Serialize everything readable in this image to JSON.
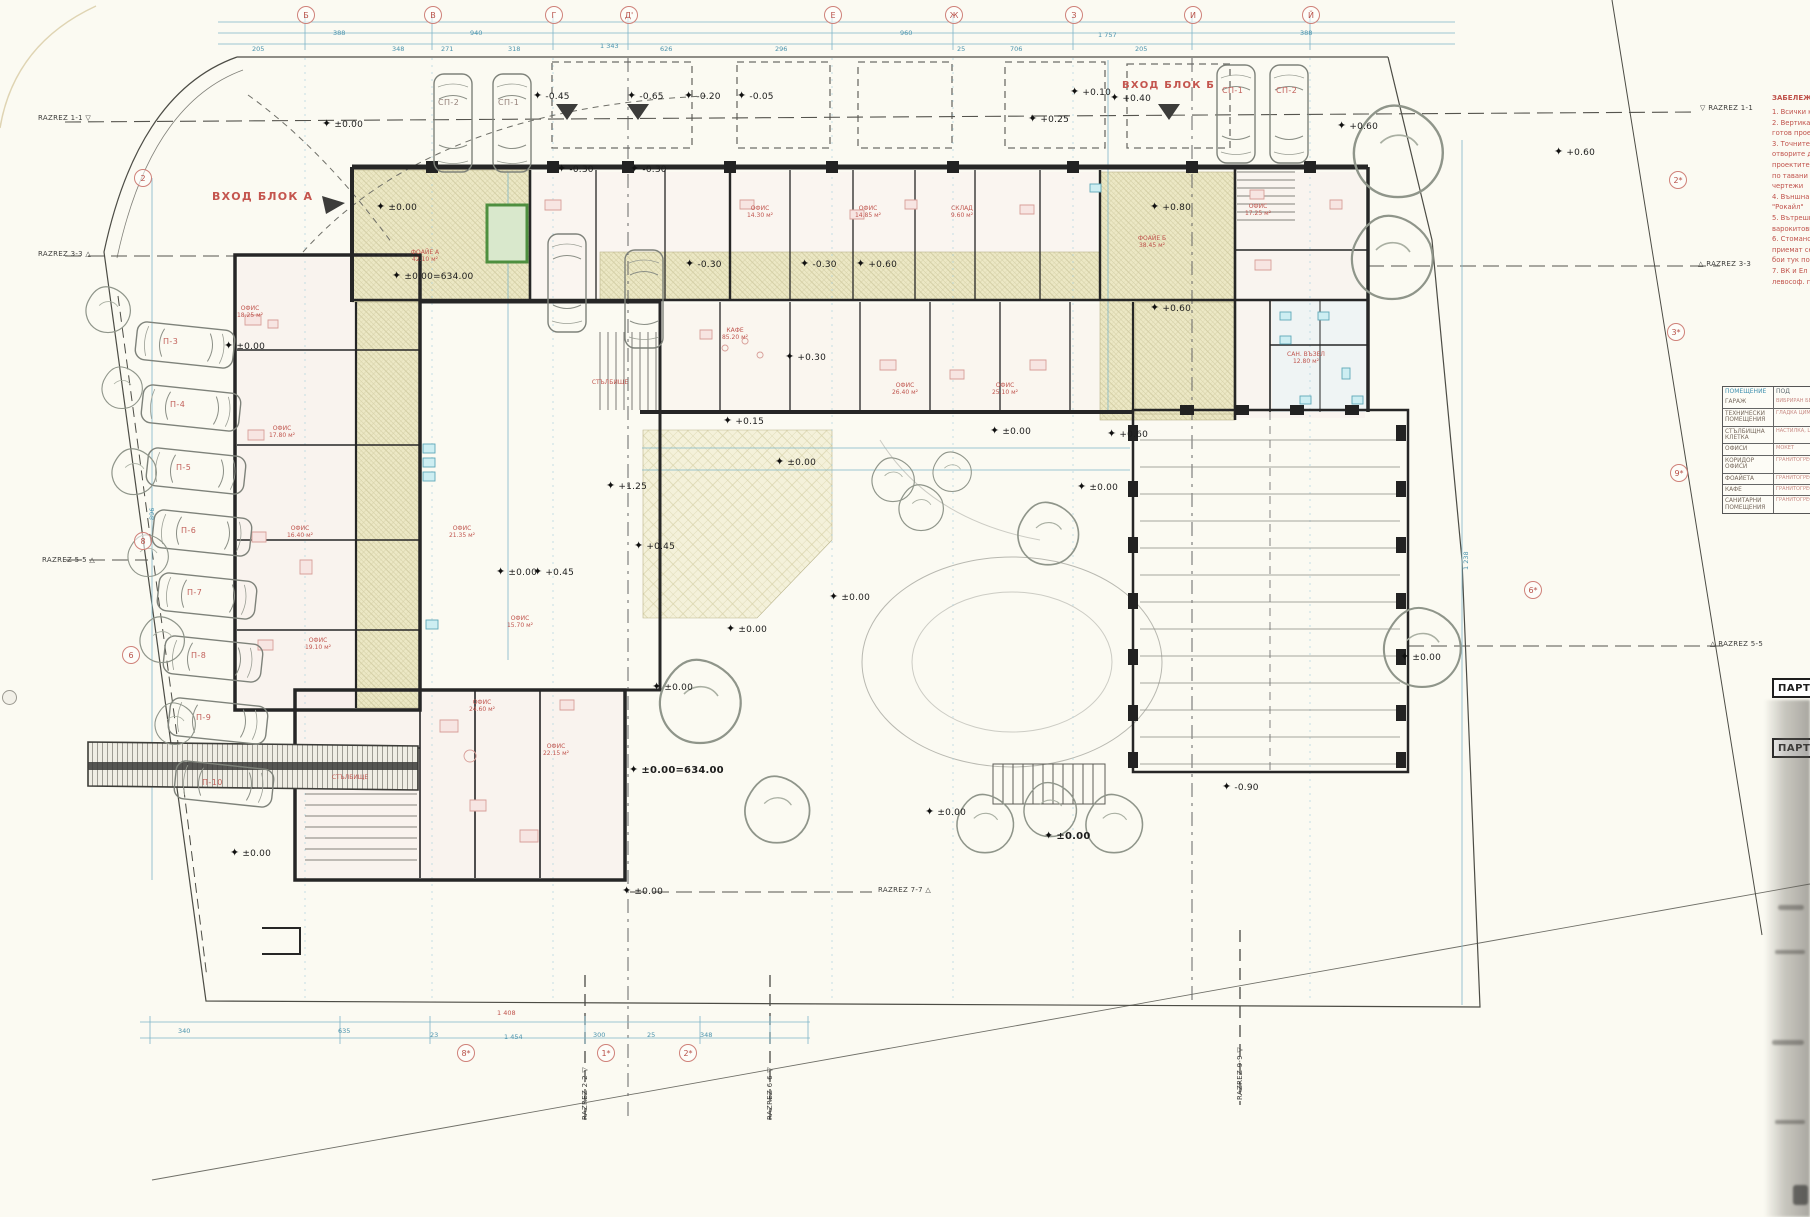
{
  "marker_glyph": "✦",
  "title_labels": {
    "entrance_a": "ВХОД БЛОК А",
    "entrance_b": "ВХОД БЛОК Б"
  },
  "grid": {
    "top": [
      {
        "t": "Б",
        "x": 305
      },
      {
        "t": "В",
        "x": 432
      },
      {
        "t": "Г",
        "x": 553
      },
      {
        "t": "Д'",
        "x": 628
      },
      {
        "t": "Е",
        "x": 832
      },
      {
        "t": "Ж",
        "x": 953
      },
      {
        "t": "З",
        "x": 1073
      },
      {
        "t": "И",
        "x": 1192
      },
      {
        "t": "Й",
        "x": 1310
      }
    ],
    "left": [
      {
        "t": "2",
        "x": 142,
        "y": 177
      },
      {
        "t": "8",
        "x": 142,
        "y": 540
      },
      {
        "t": "6",
        "x": 130,
        "y": 654
      }
    ],
    "bottom": [
      {
        "t": "8*",
        "x": 465,
        "y": 1052
      },
      {
        "t": "1*",
        "x": 605,
        "y": 1052
      },
      {
        "t": "2*",
        "x": 687,
        "y": 1052
      }
    ],
    "mid": [
      {
        "t": "2*",
        "x": 1677,
        "y": 179
      },
      {
        "t": "3*",
        "x": 1675,
        "y": 331
      },
      {
        "t": "9*",
        "x": 1678,
        "y": 472
      },
      {
        "t": "6*",
        "x": 1532,
        "y": 589
      }
    ]
  },
  "elevations": [
    {
      "t": "±0.00",
      "x": 338,
      "y": 124
    },
    {
      "t": "-0.45",
      "x": 549,
      "y": 96
    },
    {
      "t": "-0.65",
      "x": 643,
      "y": 96
    },
    {
      "t": "-0.20",
      "x": 700,
      "y": 96
    },
    {
      "t": "-0.05",
      "x": 753,
      "y": 96
    },
    {
      "t": "+0.10",
      "x": 1086,
      "y": 92
    },
    {
      "t": "+0.40",
      "x": 1126,
      "y": 98
    },
    {
      "t": "+0.25",
      "x": 1044,
      "y": 119
    },
    {
      "t": "+0.60",
      "x": 1353,
      "y": 126
    },
    {
      "t": "+0.60",
      "x": 1570,
      "y": 152
    },
    {
      "t": "±0.00",
      "x": 392,
      "y": 207
    },
    {
      "t": "±0.00=634.00",
      "x": 408,
      "y": 276
    },
    {
      "t": "-0.30",
      "x": 573,
      "y": 169
    },
    {
      "t": "-0.30",
      "x": 646,
      "y": 169
    },
    {
      "t": "-0.30",
      "x": 701,
      "y": 264
    },
    {
      "t": "-0.30",
      "x": 816,
      "y": 264
    },
    {
      "t": "+0.60",
      "x": 872,
      "y": 264
    },
    {
      "t": "+0.80",
      "x": 1166,
      "y": 207
    },
    {
      "t": "+0.60",
      "x": 1166,
      "y": 308
    },
    {
      "t": "+0.30",
      "x": 801,
      "y": 357
    },
    {
      "t": "+0.60",
      "x": 1123,
      "y": 434
    },
    {
      "t": "±0.00",
      "x": 1006,
      "y": 431
    },
    {
      "t": "+0.15",
      "x": 739,
      "y": 421
    },
    {
      "t": "±0.00",
      "x": 791,
      "y": 462
    },
    {
      "t": "+1.25",
      "x": 622,
      "y": 486
    },
    {
      "t": "+0.45",
      "x": 650,
      "y": 546
    },
    {
      "t": "+0.45",
      "x": 549,
      "y": 572
    },
    {
      "t": "±0.00",
      "x": 512,
      "y": 572
    },
    {
      "t": "±0.00",
      "x": 845,
      "y": 597
    },
    {
      "t": "±0.00",
      "x": 1093,
      "y": 487
    },
    {
      "t": "±0.00",
      "x": 742,
      "y": 629
    },
    {
      "t": "±0.00",
      "x": 668,
      "y": 687
    },
    {
      "t": "±0.00",
      "x": 240,
      "y": 346
    },
    {
      "t": "±0.00",
      "x": 246,
      "y": 853
    },
    {
      "t": "±0.00",
      "x": 1416,
      "y": 657
    },
    {
      "t": "±0.00=634.00",
      "x": 645,
      "y": 770,
      "b": 1
    },
    {
      "t": "-0.90",
      "x": 1238,
      "y": 787
    },
    {
      "t": "±0.00",
      "x": 941,
      "y": 812
    },
    {
      "t": "±0.00",
      "x": 1060,
      "y": 836,
      "b": 1
    },
    {
      "t": "±0.00",
      "x": 638,
      "y": 891
    }
  ],
  "razrez": [
    {
      "t": "RAZREZ 1-1",
      "g": "▽",
      "x": 38,
      "y": 114,
      "order": "post",
      "rot": 0
    },
    {
      "t": "RAZREZ 3-3",
      "g": "△",
      "x": 38,
      "y": 250,
      "order": "post",
      "rot": 0
    },
    {
      "t": "RAZREZ 5-5",
      "g": "△",
      "x": 42,
      "y": 556,
      "order": "post",
      "rot": 0
    },
    {
      "t": "RAZREZ 1-1",
      "g": "▽",
      "x": 1700,
      "y": 104,
      "order": "pre",
      "rot": 0
    },
    {
      "t": "RAZREZ 3-3",
      "g": "△",
      "x": 1698,
      "y": 260,
      "order": "pre",
      "rot": 0
    },
    {
      "t": "RAZREZ 5-5",
      "g": "△",
      "x": 1710,
      "y": 640,
      "order": "pre",
      "rot": 0
    },
    {
      "t": "RAZREZ 7-7",
      "g": "△",
      "x": 878,
      "y": 886,
      "order": "post",
      "rot": 0
    },
    {
      "t": "RAZREZ 2-2",
      "g": "▽",
      "x": 581,
      "y": 1120,
      "order": "post",
      "rot": -90
    },
    {
      "t": "RAZREZ 6-6",
      "g": "▽",
      "x": 766,
      "y": 1120,
      "order": "post",
      "rot": -90
    },
    {
      "t": "RAZREZ 9-9",
      "g": "▽",
      "x": 1236,
      "y": 1100,
      "order": "post",
      "rot": -90
    }
  ],
  "parking": {
    "left": [
      {
        "t": "П-3",
        "x": 163,
        "y": 337
      },
      {
        "t": "П-4",
        "x": 170,
        "y": 400
      },
      {
        "t": "П-5",
        "x": 176,
        "y": 463
      },
      {
        "t": "П-6",
        "x": 181,
        "y": 526
      },
      {
        "t": "П-7",
        "x": 187,
        "y": 588
      },
      {
        "t": "П-8",
        "x": 191,
        "y": 651
      },
      {
        "t": "П-9",
        "x": 196,
        "y": 713
      },
      {
        "t": "П-10",
        "x": 202,
        "y": 778
      }
    ],
    "top": [
      {
        "t": "СП-2",
        "x": 438,
        "y": 98,
        "red": 0
      },
      {
        "t": "СП-1",
        "x": 498,
        "y": 98,
        "red": 0
      },
      {
        "t": "СП-1",
        "x": 1222,
        "y": 86,
        "red": 1
      },
      {
        "t": "СП-2",
        "x": 1276,
        "y": 86,
        "red": 1
      }
    ]
  },
  "notes": {
    "header": "ЗАБЕЛЕЖКИ:",
    "lines": [
      "1. Всички коти са в метри",
      "2. Вертикалната планировка",
      "готов проект",
      "3. Точните размери на",
      "отворите да се вземат",
      "проектите на доставчика",
      "по тавани виж отделни",
      "чертежи",
      "4. Външна мазилка тип",
      "\"Рокайл\"",
      "5. Вътрешни мазилки -",
      "варокитови",
      "6. Стоманобетонови елем.",
      "приемат се с латексови",
      "бои тук посочени",
      "7. ВК и Ел инсталации виж",
      "левософ. проекти"
    ]
  },
  "legend": {
    "headers": [
      "ПОМЕЩЕНИЕ",
      "ПОД"
    ],
    "rows": [
      {
        "name": "ГАРАЖ",
        "floor": "ВИБРИРАН БЕТОН"
      },
      {
        "name": "ТЕХНИЧЕСКИ ПОМЕЩЕНИЯ",
        "floor": "ГЛАДКА ЦИМ. ЗАМАЗКА"
      },
      {
        "name": "СТЪЛБИЩНА КЛЕТКА",
        "floor": "НАСТИЛКА, ЦОКЪЛ"
      },
      {
        "name": "ОФИСИ",
        "floor": "МОКЕТ"
      },
      {
        "name": "КОРИДОР ОФИСИ",
        "floor": "ГРАНИТОГРЕС"
      },
      {
        "name": "ФОАЙЕТА",
        "floor": "ГРАНИТОГРЕС"
      },
      {
        "name": "КАФЕ",
        "floor": "ГРАНИТОГРЕС"
      },
      {
        "name": "САНИТАРНИ ПОМЕЩЕНИЯ",
        "floor": "ГРАНИТОГРЕС"
      }
    ]
  },
  "parter": {
    "labels": [
      "ПАРТЕР",
      "ПАРТЕР"
    ]
  },
  "rooms": [
    {
      "n": "ФОАЙЕ А",
      "a": "42.10 м²",
      "x": 425,
      "y": 250
    },
    {
      "n": "КАФЕ",
      "a": "85.20 м²",
      "x": 735,
      "y": 328
    },
    {
      "n": "ОФИС",
      "a": "18.25 м²",
      "x": 250,
      "y": 306
    },
    {
      "n": "ОФИС",
      "a": "17.80 м²",
      "x": 282,
      "y": 426
    },
    {
      "n": "ОФИС",
      "a": "16.40 м²",
      "x": 300,
      "y": 526
    },
    {
      "n": "ОФИС",
      "a": "19.10 м²",
      "x": 318,
      "y": 638
    },
    {
      "n": "ОФИС",
      "a": "21.35 м²",
      "x": 462,
      "y": 526
    },
    {
      "n": "ОФИС",
      "a": "15.70 м²",
      "x": 520,
      "y": 616
    },
    {
      "n": "ОФИС",
      "a": "24.60 м²",
      "x": 482,
      "y": 700
    },
    {
      "n": "ОФИС",
      "a": "22.15 м²",
      "x": 556,
      "y": 744
    },
    {
      "n": "ОФИС",
      "a": "14.30 м²",
      "x": 760,
      "y": 206
    },
    {
      "n": "ОФИС",
      "a": "14.85 м²",
      "x": 868,
      "y": 206
    },
    {
      "n": "СКЛАД",
      "a": "9.60 м²",
      "x": 962,
      "y": 206
    },
    {
      "n": "ОФИС",
      "a": "26.40 м²",
      "x": 905,
      "y": 383
    },
    {
      "n": "ОФИС",
      "a": "25.10 м²",
      "x": 1005,
      "y": 383
    },
    {
      "n": "ФОАЙЕ Б",
      "a": "38.45 м²",
      "x": 1152,
      "y": 236
    },
    {
      "n": "ОФИС",
      "a": "17.25 м²",
      "x": 1258,
      "y": 204
    },
    {
      "n": "САН. ВЪЗЕЛ",
      "a": "12.80 м²",
      "x": 1306,
      "y": 352
    },
    {
      "n": "СТЪЛБИЩЕ",
      "a": "",
      "x": 610,
      "y": 380
    },
    {
      "n": "СТЪЛБИЩЕ",
      "a": "",
      "x": 350,
      "y": 775
    }
  ],
  "dims": {
    "top": [
      {
        "t": "205",
        "x": 252,
        "y": 45
      },
      {
        "t": "388",
        "x": 333,
        "y": 29
      },
      {
        "t": "348",
        "x": 392,
        "y": 45
      },
      {
        "t": "271",
        "x": 441,
        "y": 45
      },
      {
        "t": "318",
        "x": 508,
        "y": 45
      },
      {
        "t": "1 343",
        "x": 600,
        "y": 42
      },
      {
        "t": "940",
        "x": 470,
        "y": 29
      },
      {
        "t": "626",
        "x": 660,
        "y": 45
      },
      {
        "t": "296",
        "x": 775,
        "y": 45
      },
      {
        "t": "960",
        "x": 900,
        "y": 29
      },
      {
        "t": "25",
        "x": 957,
        "y": 45
      },
      {
        "t": "706",
        "x": 1010,
        "y": 45
      },
      {
        "t": "1 757",
        "x": 1098,
        "y": 31
      },
      {
        "t": "205",
        "x": 1135,
        "y": 45
      },
      {
        "t": "388",
        "x": 1300,
        "y": 29
      }
    ],
    "bottom": [
      {
        "t": "1 408",
        "x": 497,
        "y": 1009,
        "red": 1
      },
      {
        "t": "1 454",
        "x": 504,
        "y": 1033
      },
      {
        "t": "340",
        "x": 178,
        "y": 1027
      },
      {
        "t": "635",
        "x": 338,
        "y": 1027
      },
      {
        "t": "23",
        "x": 430,
        "y": 1031
      },
      {
        "t": "300",
        "x": 593,
        "y": 1031
      },
      {
        "t": "25",
        "x": 647,
        "y": 1031
      },
      {
        "t": "348",
        "x": 700,
        "y": 1031
      }
    ],
    "side": [
      {
        "t": "1 238",
        "x": 1462,
        "y": 570
      },
      {
        "t": "896",
        "x": 148,
        "y": 520
      }
    ]
  }
}
